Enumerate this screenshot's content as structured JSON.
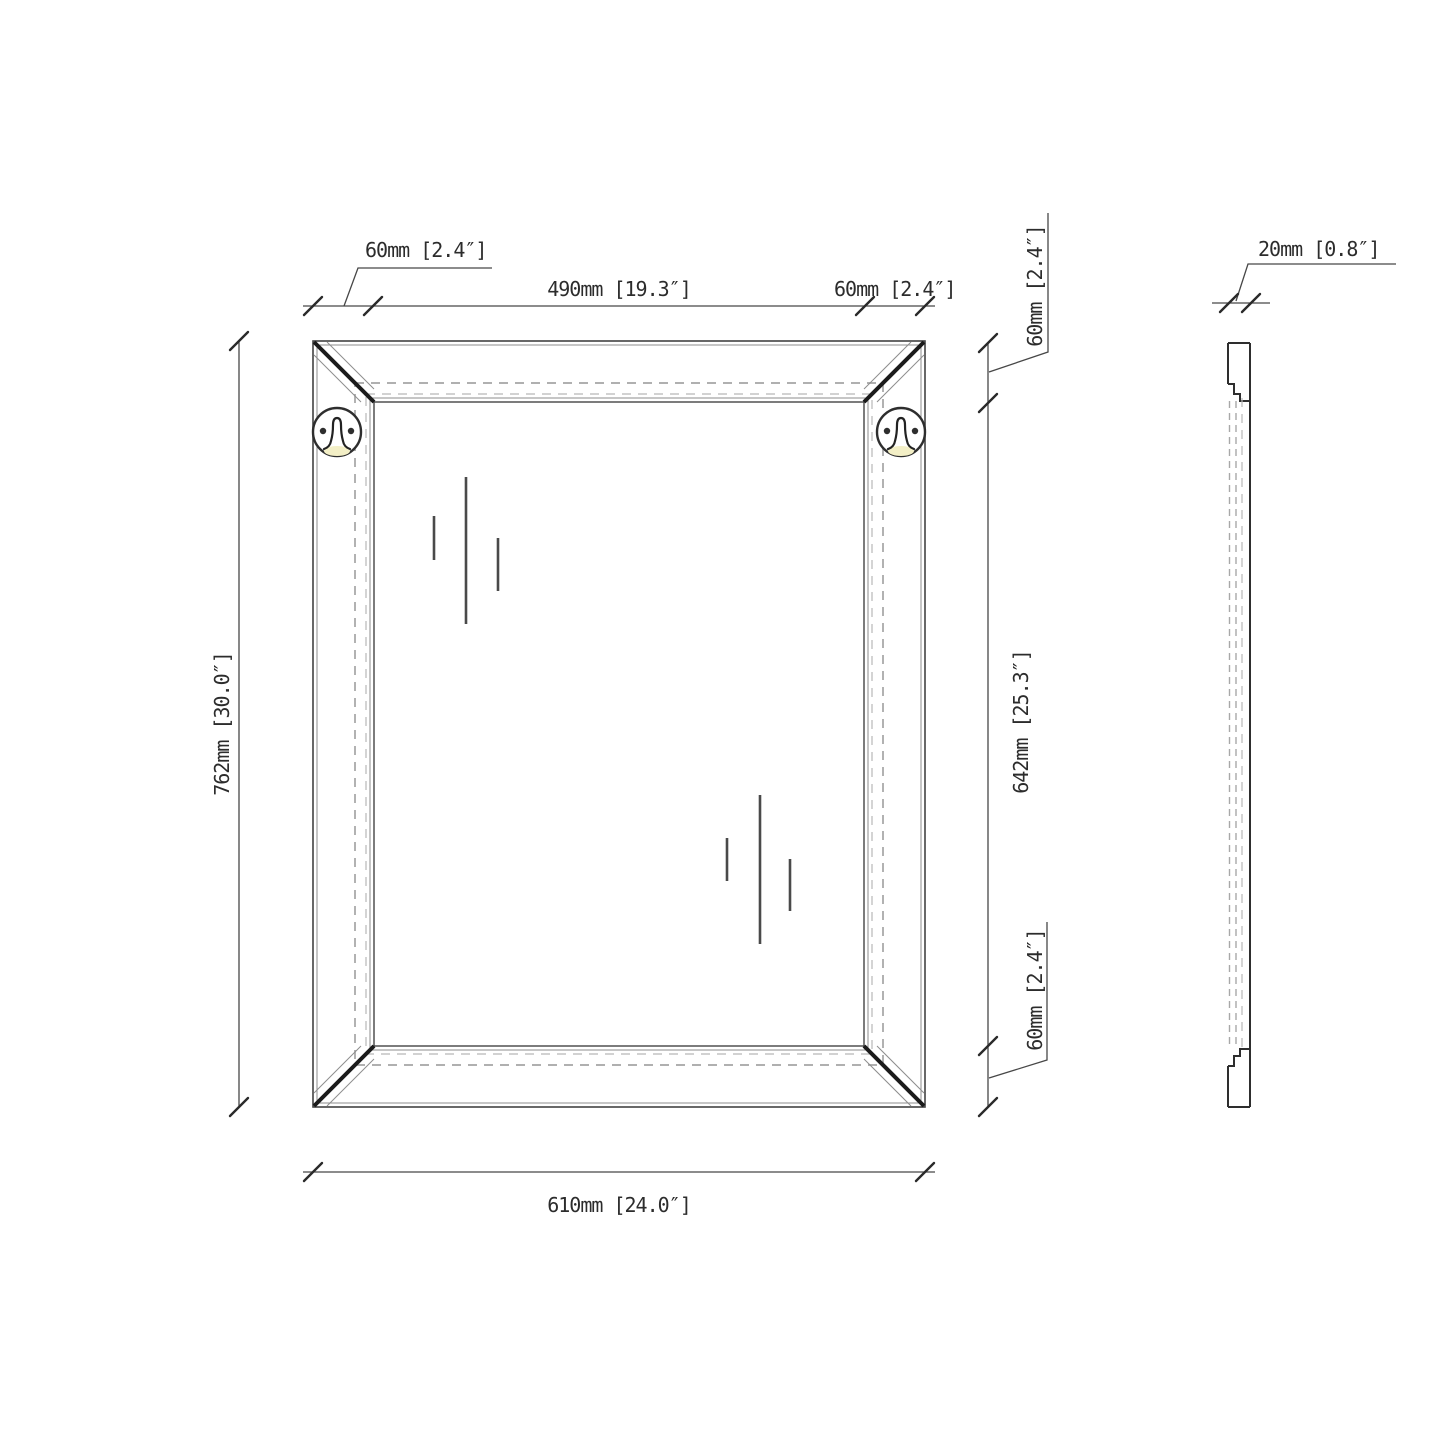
{
  "dimensions": {
    "frame_width_left": "60mm [2.4″]",
    "opening_width": "490mm [19.3″]",
    "frame_width_right": "60mm [2.4″]",
    "overall_height": "762mm [30.0″]",
    "frame_height_top": "60mm [2.4″]",
    "opening_height": "642mm [25.3″]",
    "frame_height_bottom": "60mm [2.4″]",
    "overall_width": "610mm [24.0″]",
    "thickness": "20mm [0.8″]"
  },
  "icons": {
    "hanger": "keyhole-hanger-bracket"
  },
  "colors": {
    "line": "#424242",
    "hidden_line": "#a5a5a5",
    "hanger_highlight": "#f3efc6",
    "background": "#ffffff"
  }
}
